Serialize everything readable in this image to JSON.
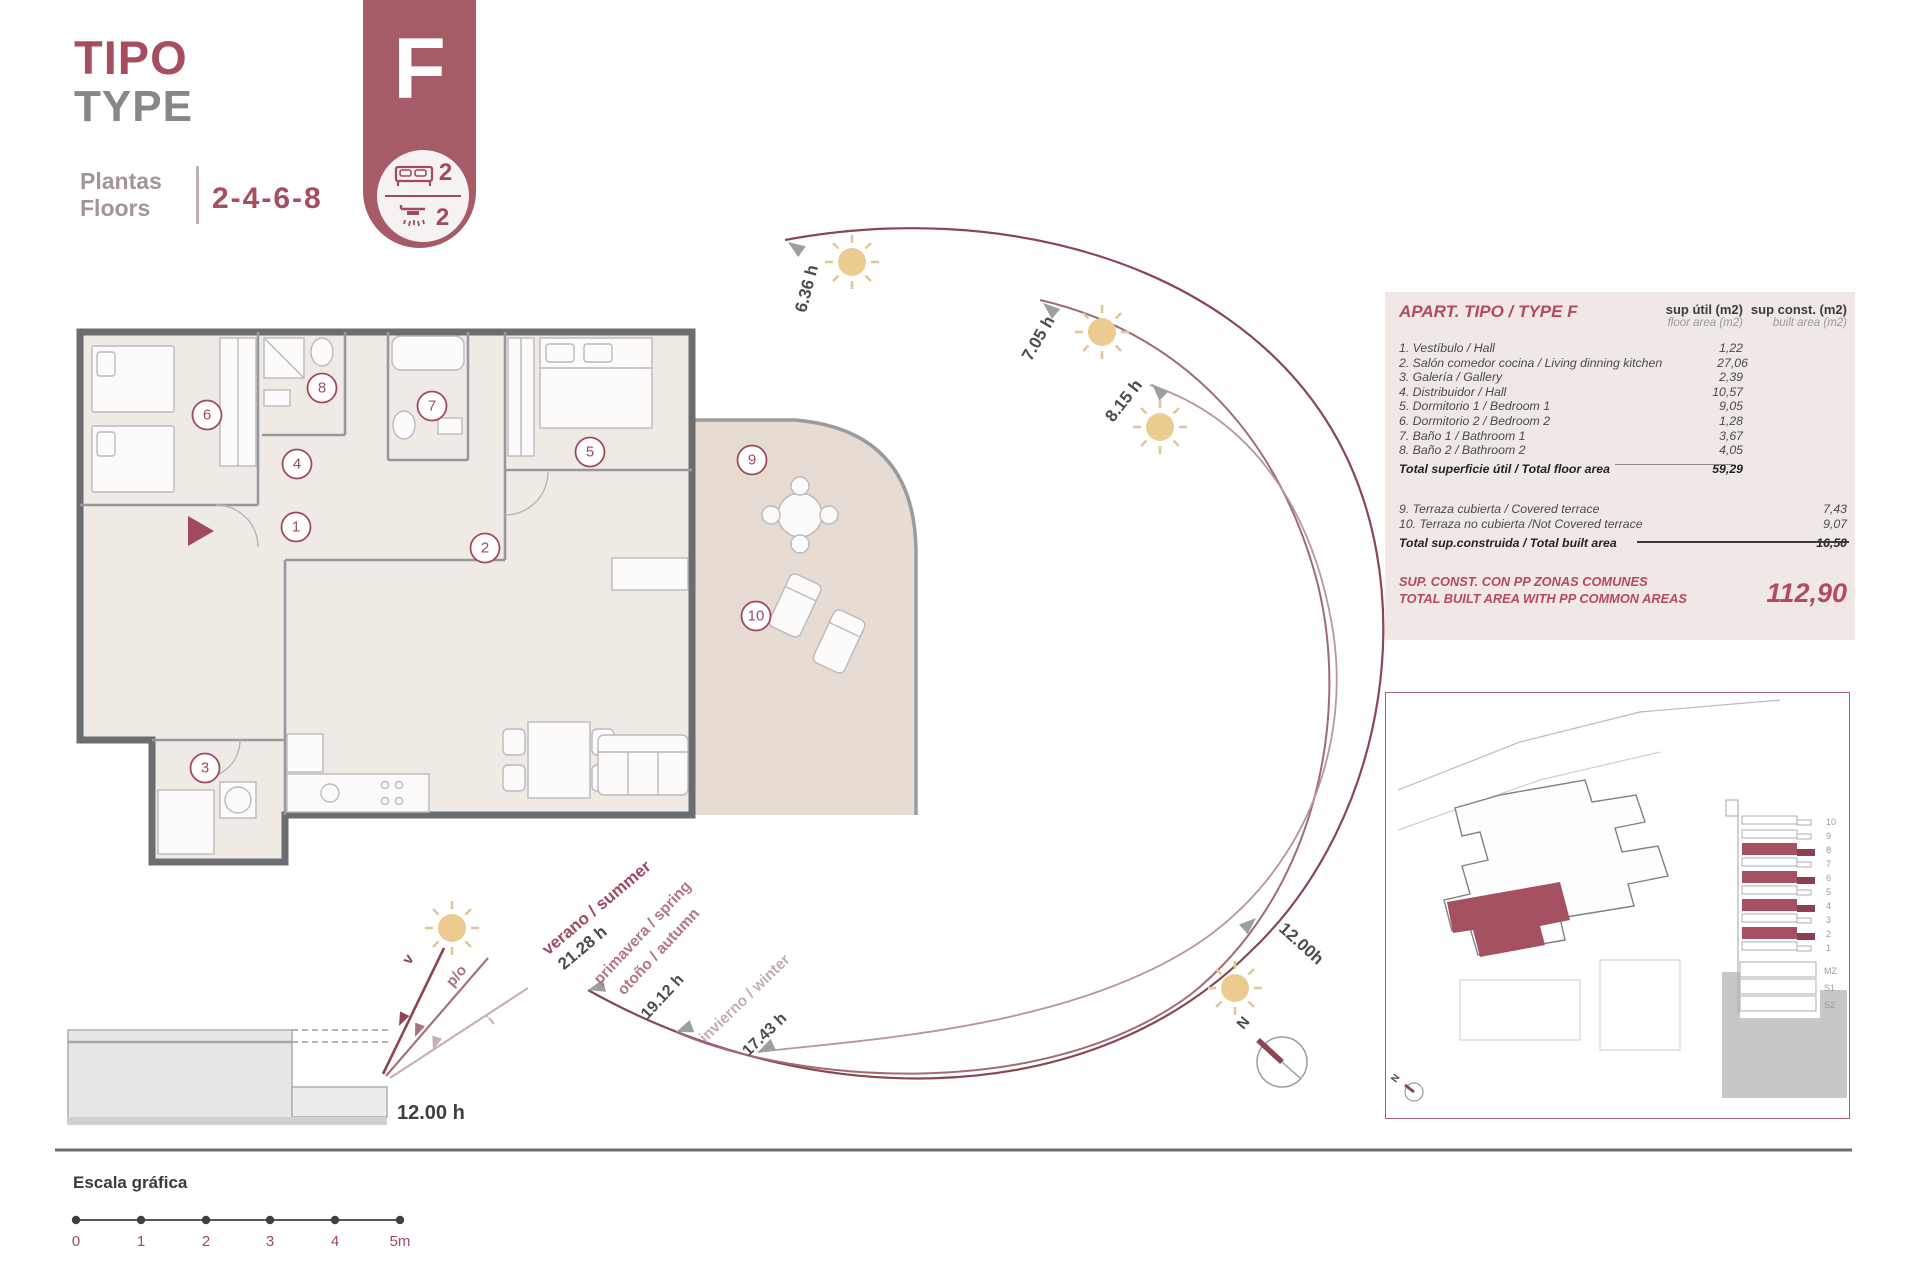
{
  "header": {
    "title_es": "TIPO",
    "title_en": "TYPE",
    "floors_label_es": "Plantas",
    "floors_label_en": "Floors",
    "floors_value": "2-4-6-8"
  },
  "badge": {
    "letter": "F",
    "bedrooms": "2",
    "bathrooms": "2"
  },
  "plan": {
    "room_numbers": [
      "1",
      "2",
      "3",
      "4",
      "5",
      "6",
      "7",
      "8",
      "9",
      "10"
    ]
  },
  "sun_path": {
    "sunrise_times": [
      "6.36 h",
      "7.05 h",
      "8.15 h"
    ],
    "noon_time": "12.00h",
    "seasons": [
      {
        "name1": "verano / summer",
        "time": "21.28 h"
      },
      {
        "name1": "primavera / spring",
        "name2": "otoño / autumn",
        "time": "19.12 h"
      },
      {
        "name1": "invierno / winter",
        "time": "17.43 h"
      }
    ],
    "north_label": "N"
  },
  "section": {
    "ray_labels": [
      "v",
      "p/o",
      "i"
    ],
    "time": "12.00 h"
  },
  "scale_bar": {
    "title": "Escala gráfica",
    "ticks": [
      "0",
      "1",
      "2",
      "3",
      "4",
      "5m"
    ]
  },
  "area_table": {
    "title": "APART. TIPO / TYPE F",
    "col1_title": "sup útil (m2)",
    "col1_sub": "floor area (m2)",
    "col2_title": "sup const. (m2)",
    "col2_sub": "built area (m2)",
    "rows": [
      {
        "label": "1. Vestíbulo / Hall",
        "util": "1,22"
      },
      {
        "label": "2. Salón comedor cocina / Living dinning kitchen",
        "util": "27,06"
      },
      {
        "label": "3. Galería / Gallery",
        "util": "2,39"
      },
      {
        "label": "4. Distribuidor / Hall",
        "util": "10,57"
      },
      {
        "label": "5. Dormitorio 1 / Bedroom 1",
        "util": "9,05"
      },
      {
        "label": "6. Dormitorio 2 / Bedroom 2",
        "util": "1,28"
      },
      {
        "label": "7. Baño 1 / Bathroom 1",
        "util": "3,67"
      },
      {
        "label": "8. Baño 2 / Bathroom 2",
        "util": "4,05"
      }
    ],
    "total_floor": {
      "label": "Total superficie útil / Total floor area",
      "value": "59,29"
    },
    "terrace_rows": [
      {
        "label": "9. Terraza cubierta / Covered terrace",
        "const": "7,43"
      },
      {
        "label": "10. Terraza no cubierta /Not Covered terrace",
        "const": "9,07"
      }
    ],
    "total_built": {
      "label": "Total sup.construida / Total built area",
      "value": "16,50"
    },
    "summary": {
      "label_es": "SUP. CONST. CON PP ZONAS COMUNES",
      "label_en": "TOTAL BUILT AREA WITH PP COMMON AREAS",
      "value": "112,90"
    }
  },
  "inset": {
    "floors": [
      "10",
      "9",
      "8",
      "7",
      "6",
      "5",
      "4",
      "3",
      "2",
      "1",
      "MZ",
      "S1",
      "S2"
    ],
    "highlighted_floors": [
      "8",
      "6",
      "4",
      "2"
    ],
    "north_label": "N"
  },
  "colors": {
    "maroon": "#a04a5e",
    "badge": "#a65b69",
    "table_bg": "#efe8e4",
    "room_fill": "#f0eae5",
    "terrace_fill": "#e6dcd3",
    "wall": "#6c6d70",
    "sun": "#eccb90",
    "arc_outer": "#8a4752",
    "arc_middle": "#a06b74",
    "arc_inner": "#b8969c"
  }
}
